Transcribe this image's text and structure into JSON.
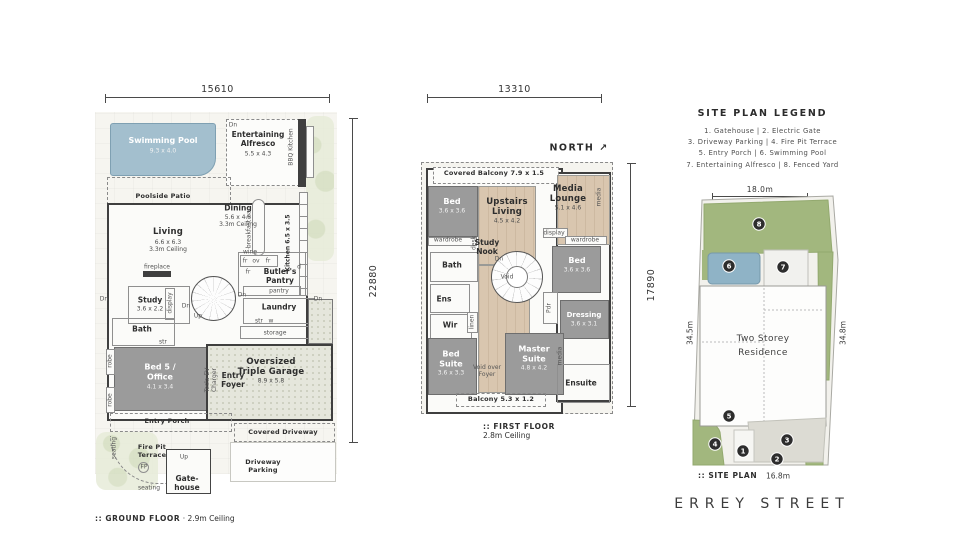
{
  "colors": {
    "wall": "#3f3f3f",
    "grayroom": "#9b9b9b",
    "wood": "#d9c6af",
    "pool": "#a3bfce",
    "site_green": "#a2b77e",
    "site_pool": "#8fb3c6",
    "marker": "#2d2d2d"
  },
  "ground_floor": {
    "dim_width": "15610",
    "dim_height": "22880",
    "caption": ":: GROUND FLOOR",
    "caption_detail": "· 2.9m Ceiling",
    "labels": [
      [
        "Swimming Pool",
        163,
        141,
        "rw"
      ],
      [
        "9.3 x 4.0",
        163,
        151,
        "rdw"
      ],
      [
        "Dn",
        233,
        125,
        "xs"
      ],
      [
        "Entertaining\nAlfresco",
        258,
        139,
        "rn2"
      ],
      [
        "5.5 x 4.3",
        258,
        154,
        "rd"
      ],
      [
        "BBQ Kitchen",
        291,
        147,
        "xs v"
      ],
      [
        "Poolside Patio",
        163,
        197,
        "sm"
      ],
      [
        "Dining",
        238,
        208,
        "rn2"
      ],
      [
        "5.6 x 4.5\n3.3m Ceiling",
        238,
        221,
        "rd"
      ],
      [
        "breakfast bar",
        249,
        228,
        "xs v"
      ],
      [
        "Kitchen 6.5 x 3.5",
        288,
        243,
        "xsb v"
      ],
      [
        "Living",
        168,
        232,
        "rn"
      ],
      [
        "6.6 x 6.3\n3.3m Ceiling",
        168,
        246,
        "rd"
      ],
      [
        "wine",
        250,
        252,
        "xs"
      ],
      [
        "fr",
        245,
        261,
        "xs"
      ],
      [
        "ov",
        256,
        261,
        "xs"
      ],
      [
        "fr",
        268,
        261,
        "xs"
      ],
      [
        "fr",
        248,
        272,
        "xs"
      ],
      [
        "d",
        299,
        267,
        "xs"
      ],
      [
        "Butler's\nPantry",
        280,
        276,
        "rn2"
      ],
      [
        "pantry",
        279,
        291,
        "xs"
      ],
      [
        "fireplace",
        157,
        267,
        "xs"
      ],
      [
        "Study",
        150,
        300,
        "rn2"
      ],
      [
        "3.6 x 2.2",
        150,
        309,
        "rd"
      ],
      [
        "display",
        170,
        303,
        "xs v"
      ],
      [
        "Dn",
        104,
        299,
        "xs"
      ],
      [
        "Dn",
        318,
        299,
        "xs"
      ],
      [
        "Dn",
        186,
        306,
        "xs"
      ],
      [
        "Up",
        198,
        316,
        "xs"
      ],
      [
        "Dn",
        242,
        295,
        "xs"
      ],
      [
        "Laundry",
        279,
        307,
        "rn2"
      ],
      [
        "str",
        259,
        321,
        "xs"
      ],
      [
        "w",
        271,
        321,
        "xs"
      ],
      [
        "storage",
        275,
        333,
        "xs"
      ],
      [
        "Bath",
        142,
        329,
        "rn2"
      ],
      [
        "str",
        163,
        342,
        "xs"
      ],
      [
        "robe",
        110,
        361,
        "xs v"
      ],
      [
        "robe",
        110,
        400,
        "xs v"
      ],
      [
        "Bed 5 /\nOffice",
        160,
        372,
        "rw"
      ],
      [
        "4.1 x 3.4",
        160,
        387,
        "rdw"
      ],
      [
        "Entry\nFoyer",
        233,
        380,
        "rn2"
      ],
      [
        "Tesla EV\nCharger",
        211,
        380,
        "xs v"
      ],
      [
        "Oversized\nTriple Garage",
        271,
        367,
        "rn"
      ],
      [
        "8.9 x 5.8",
        271,
        381,
        "rd"
      ],
      [
        "Entry Porch",
        167,
        422,
        "sm"
      ],
      [
        "Covered Driveway",
        283,
        433,
        "sm"
      ],
      [
        "Fire Pit\nTerrace",
        152,
        452,
        "sm"
      ],
      [
        "FP",
        144,
        467,
        "xs"
      ],
      [
        "seating",
        114,
        448,
        "xs v"
      ],
      [
        "seating",
        149,
        488,
        "xs"
      ],
      [
        "Up",
        184,
        457,
        "xs"
      ],
      [
        "Gate-\nhouse",
        187,
        483,
        "rn2"
      ],
      [
        "Driveway\nParking",
        263,
        467,
        "sm"
      ]
    ]
  },
  "first_floor": {
    "dim_width": "13310",
    "dim_height": "17890",
    "caption": ":: FIRST FLOOR",
    "caption_detail": "2.8m Ceiling",
    "labels": [
      [
        "NORTH ↗",
        579,
        148,
        "north"
      ],
      [
        "Covered Balcony 7.9 x 1.5",
        494,
        174,
        "sm"
      ],
      [
        "Bed",
        452,
        202,
        "rw"
      ],
      [
        "3.6 x 3.6",
        452,
        211,
        "rdw"
      ],
      [
        "wardrobe",
        448,
        240,
        "xs"
      ],
      [
        "desk",
        474,
        243,
        "xs v"
      ],
      [
        "Upstairs\nLiving",
        507,
        207,
        "rn"
      ],
      [
        "4.5 x 4.2",
        507,
        221,
        "rd"
      ],
      [
        "Study\nNook",
        487,
        247,
        "rn2"
      ],
      [
        "Media\nLounge",
        568,
        194,
        "rn"
      ],
      [
        "5.1 x 4.6",
        568,
        208,
        "rd"
      ],
      [
        "media",
        599,
        197,
        "xs v"
      ],
      [
        "display",
        554,
        233,
        "xs"
      ],
      [
        "wardrobe",
        585,
        240,
        "xs"
      ],
      [
        "Bath",
        452,
        265,
        "rn2"
      ],
      [
        "Ens",
        444,
        299,
        "rn2"
      ],
      [
        "Wir",
        450,
        325,
        "rn2"
      ],
      [
        "linen",
        472,
        322,
        "xs v"
      ],
      [
        "Dn",
        499,
        259,
        "xs"
      ],
      [
        "Void",
        507,
        277,
        "xs"
      ],
      [
        "Bed",
        577,
        261,
        "rw"
      ],
      [
        "3.6 x 3.6",
        577,
        270,
        "rdw"
      ],
      [
        "Pdr",
        549,
        308,
        "xs v"
      ],
      [
        "Dressing",
        584,
        315,
        "rw2"
      ],
      [
        "3.6 x 3.1",
        584,
        324,
        "rdw"
      ],
      [
        "Bed\nSuite",
        451,
        359,
        "rw"
      ],
      [
        "3.6 x 3.3",
        451,
        373,
        "rdw"
      ],
      [
        "Void over\nFoyer",
        487,
        371,
        "xs"
      ],
      [
        "Master\nSuite",
        534,
        354,
        "rw"
      ],
      [
        "4.8 x 4.2",
        534,
        368,
        "rdw"
      ],
      [
        "media",
        560,
        356,
        "xs v"
      ],
      [
        "Ensuite",
        581,
        383,
        "rn2"
      ],
      [
        "Balcony 5.3 x 1.2",
        501,
        400,
        "sm"
      ]
    ]
  },
  "site_plan": {
    "legend_title": "SITE PLAN LEGEND",
    "legend_lines": [
      "1. Gatehouse | 2. Electric Gate",
      "3. Driveway Parking | 4. Fire Pit Terrace",
      "5. Entry Porch | 6. Swimming Pool",
      "7. Entertaining Alfresco | 8. Fenced Yard"
    ],
    "dim_top": "18.0m",
    "caption": ":: SITE PLAN",
    "street": "ERREY STREET",
    "labels": [
      [
        "34.5m",
        690,
        333,
        "dimv v"
      ],
      [
        "34.8m",
        843,
        333,
        "dimv v"
      ],
      [
        "16.8m",
        778,
        476,
        "dimt"
      ],
      [
        "Two Storey\nResidence",
        763,
        347,
        "res"
      ]
    ],
    "markers": [
      {
        "n": "1",
        "x": 57,
        "y": 259
      },
      {
        "n": "2",
        "x": 91,
        "y": 267
      },
      {
        "n": "3",
        "x": 101,
        "y": 248
      },
      {
        "n": "4",
        "x": 29,
        "y": 252
      },
      {
        "n": "5",
        "x": 43,
        "y": 224
      },
      {
        "n": "6",
        "x": 43,
        "y": 74
      },
      {
        "n": "7",
        "x": 97,
        "y": 75
      },
      {
        "n": "8",
        "x": 73,
        "y": 32
      }
    ]
  }
}
